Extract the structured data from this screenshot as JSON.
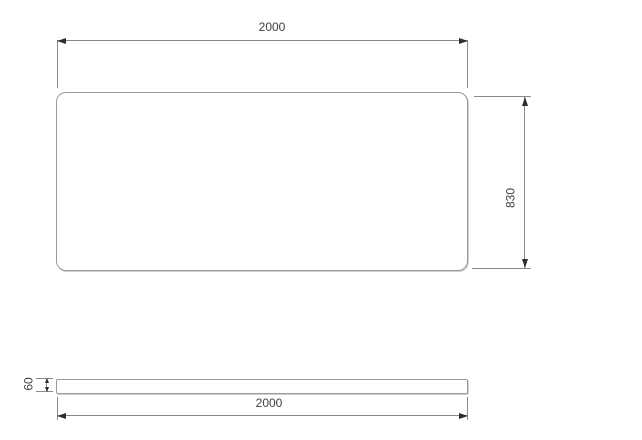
{
  "drawing": {
    "type": "technical-dimension-drawing",
    "top_view": {
      "width_label": "2000",
      "height_label": "830"
    },
    "side_view": {
      "thickness_label": "60",
      "width_label": "2000"
    },
    "colors": {
      "line": "#9a9a9a",
      "dimension_line": "#8a8a8a",
      "arrow": "#2e2e2e",
      "text": "#3f3f3f",
      "background": "#ffffff"
    }
  }
}
